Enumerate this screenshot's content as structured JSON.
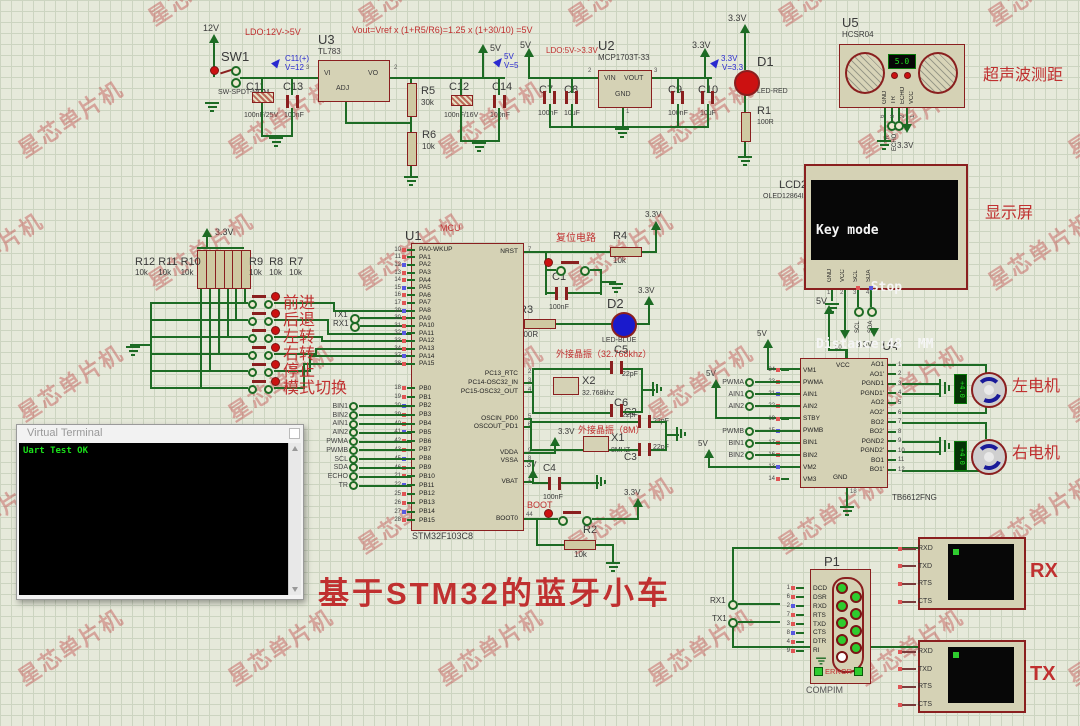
{
  "watermark": {
    "text": "星芯单片机"
  },
  "title": {
    "text": "基于STM32的蓝牙小车"
  },
  "rails": {
    "v12": "12V",
    "v5": "5V",
    "v33": "3.3V"
  },
  "notes": {
    "ldo1": "LDO:12V->5V",
    "formula": "Vout=Vref x (1+R5/R6)=1.25 x (1+30/10) =5V",
    "ldo2": "LDO:5V->3.3V",
    "reset": "复位电路",
    "xtal_lse": "外接晶振（32.768khz）",
    "xtal_hse": "外接晶振（8M）",
    "boot": "BOOT",
    "mcu_tag": "MCU",
    "ultrasonic": "超声波测距",
    "display": "显示屏",
    "motor_left": "左电机",
    "motor_right": "右电机"
  },
  "probes": {
    "c11": {
      "label": "C11(+)",
      "v": "V=12"
    },
    "v5": {
      "label": "5V",
      "v": "V=5"
    },
    "v33": {
      "label": "3.3V",
      "v": "V=3.3"
    }
  },
  "sw1": {
    "ref": "SW1",
    "val": "SW-SPDT-MOM"
  },
  "u3": {
    "ref": "U3",
    "val": "TL783",
    "vi": "VI",
    "vo": "VO",
    "adj": "ADJ",
    "n_in": "3",
    "n_out": "2"
  },
  "u2": {
    "ref": "U2",
    "val": "MCP1703T-33",
    "vin": "VIN",
    "vout": "VOUT",
    "gnd": "GND",
    "n_in": "2",
    "n_out": "3",
    "n_gnd": "1"
  },
  "caps": {
    "c11": {
      "ref": "C11",
      "val": "100nF/25V"
    },
    "c13": {
      "ref": "C13",
      "val": "100nF"
    },
    "c12": {
      "ref": "C12",
      "val": "100nF/16V"
    },
    "c14": {
      "ref": "C14",
      "val": "100nF"
    },
    "c7": {
      "ref": "C7",
      "val": "100nF"
    },
    "c8": {
      "ref": "C8",
      "val": "10uF"
    },
    "c9": {
      "ref": "C9",
      "val": "100nF"
    },
    "c10": {
      "ref": "C10",
      "val": "10uF"
    },
    "c1": {
      "ref": "C1",
      "val": "100nF"
    },
    "c5": {
      "ref": "C5",
      "val": "22pF"
    },
    "c6": {
      "ref": "C6",
      "val": "22pF"
    },
    "c2": {
      "ref": "C2",
      "val": "22pF"
    },
    "c3": {
      "ref": "C3",
      "val": "22pF"
    },
    "c4": {
      "ref": "C4",
      "val": "100nF"
    }
  },
  "resistors": {
    "r5": {
      "ref": "R5",
      "val": "30k"
    },
    "r6": {
      "ref": "R6",
      "val": "10k"
    },
    "r1": {
      "ref": "R1",
      "val": "100R"
    },
    "r4": {
      "ref": "R4",
      "val": "10k"
    },
    "r3": {
      "ref": "R3",
      "val": "100R"
    },
    "r2": {
      "ref": "R2",
      "val": "10k"
    }
  },
  "leds": {
    "d1": {
      "ref": "D1",
      "val": "LED-RED"
    },
    "d2": {
      "ref": "D2",
      "val": "LED-BLUE"
    }
  },
  "xtals": {
    "x2": {
      "ref": "X2",
      "val": "32.768khz"
    },
    "x1": {
      "ref": "X1",
      "val": "8MHZ"
    }
  },
  "ultrasonic": {
    "ref": "U5",
    "val": "HCSR04",
    "display": "5.0",
    "pins": [
      "GND",
      "TR",
      "ECHO",
      "VCC"
    ],
    "pin_numbers": [
      "6",
      "3",
      "2",
      "1"
    ],
    "terms": [
      "TR",
      "ECHO"
    ]
  },
  "lcd": {
    "ref": "LCD2",
    "val": "OLED12864I2C",
    "lines": [
      "Key mode",
      "       Stop",
      "Distance:48  MM"
    ],
    "pins": [
      {
        "n": "1",
        "name": "GND"
      },
      {
        "n": "2",
        "name": "VCC"
      },
      {
        "n": "3",
        "name": "SCL"
      },
      {
        "n": "4",
        "name": "SDA"
      }
    ],
    "terms": [
      "SCL",
      "SDA"
    ]
  },
  "mcu": {
    "ref": "U1",
    "val": "STM32F103C8",
    "pa_pins": [
      {
        "n": "10",
        "name": "PA0-WKUP"
      },
      {
        "n": "11",
        "name": "PA1"
      },
      {
        "n": "12",
        "name": "PA2"
      },
      {
        "n": "13",
        "name": "PA3"
      },
      {
        "n": "14",
        "name": "PA4"
      },
      {
        "n": "15",
        "name": "PA5"
      },
      {
        "n": "16",
        "name": "PA6"
      },
      {
        "n": "17",
        "name": "PA7"
      },
      {
        "n": "29",
        "name": "PA8"
      },
      {
        "n": "30",
        "name": "PA9"
      },
      {
        "n": "31",
        "name": "PA10"
      },
      {
        "n": "32",
        "name": "PA11"
      },
      {
        "n": "33",
        "name": "PA12"
      },
      {
        "n": "34",
        "name": "PA13"
      },
      {
        "n": "37",
        "name": "PA14"
      },
      {
        "n": "38",
        "name": "PA15"
      }
    ],
    "pb_pins": [
      {
        "n": "18",
        "name": "PB0"
      },
      {
        "n": "19",
        "name": "PB1"
      },
      {
        "n": "20",
        "name": "PB2"
      },
      {
        "n": "39",
        "name": "PB3"
      },
      {
        "n": "40",
        "name": "PB4"
      },
      {
        "n": "41",
        "name": "PB5"
      },
      {
        "n": "42",
        "name": "PB6"
      },
      {
        "n": "43",
        "name": "PB7"
      },
      {
        "n": "45",
        "name": "PB8"
      },
      {
        "n": "46",
        "name": "PB9"
      },
      {
        "n": "21",
        "name": "PB10"
      },
      {
        "n": "22",
        "name": "PB11"
      },
      {
        "n": "25",
        "name": "PB12"
      },
      {
        "n": "26",
        "name": "PB13"
      },
      {
        "n": "27",
        "name": "PB14"
      },
      {
        "n": "28",
        "name": "PB15"
      }
    ],
    "right_pins": [
      {
        "n": "7",
        "name": "NRST"
      },
      {
        "n": "2",
        "name": "PC13_RTC"
      },
      {
        "n": "3",
        "name": "PC14-OSC32_IN"
      },
      {
        "n": "4",
        "name": "PC15-OSC32_OUT"
      },
      {
        "n": "5",
        "name": "OSCIN_PD0"
      },
      {
        "n": "6",
        "name": "OSCOUT_PD1"
      },
      {
        "n": "9",
        "name": "VDDA"
      },
      {
        "n": "8",
        "name": "VSSA"
      },
      {
        "n": "1",
        "name": "VBAT"
      },
      {
        "n": "44",
        "name": "BOOT0"
      }
    ]
  },
  "keys": {
    "res_left": [
      {
        "ref": "R12",
        "val": "10k"
      },
      {
        "ref": "R11",
        "val": "10k"
      },
      {
        "ref": "R10",
        "val": "10k"
      }
    ],
    "res_right": [
      {
        "ref": "R9",
        "val": "10k"
      },
      {
        "ref": "R8",
        "val": "10k"
      },
      {
        "ref": "R7",
        "val": "10k"
      }
    ],
    "buttons": [
      "前进",
      "后退",
      "左转",
      "右转",
      "停止",
      "模式切换"
    ]
  },
  "uart": {
    "tx1": "TX1",
    "rx1": "RX1"
  },
  "mcu_terms": [
    "BIN1",
    "BIN2",
    "AIN1",
    "AIN2",
    "PWMA",
    "PWMB",
    "SCL",
    "SDA",
    "ECHO",
    "TR"
  ],
  "terminal_window": {
    "title": "Virtual Terminal",
    "text": "Uart Test OK"
  },
  "driver": {
    "ref": "U4",
    "val": "TB6612FNG",
    "vcc": {
      "n": "20",
      "name": "VCC"
    },
    "gnd": {
      "n": "18",
      "name": "GND"
    },
    "left_pins": [
      {
        "n": "24",
        "name": "VM1"
      },
      {
        "n": "23",
        "name": "PWMA"
      },
      {
        "n": "21",
        "name": "AIN1"
      },
      {
        "n": "22",
        "name": "AIN2"
      },
      {
        "n": "19",
        "name": "STBY"
      },
      {
        "n": "15",
        "name": "PWMB"
      },
      {
        "n": "17",
        "name": "BIN1"
      },
      {
        "n": "16",
        "name": "BIN2"
      },
      {
        "n": "13",
        "name": "VM2"
      },
      {
        "n": "14",
        "name": "VM3"
      }
    ],
    "right_pins": [
      {
        "n": "1",
        "name": "AO1"
      },
      {
        "n": "2",
        "name": "AO1'"
      },
      {
        "n": "3",
        "name": "PGND1"
      },
      {
        "n": "4",
        "name": "PGND1'"
      },
      {
        "n": "5",
        "name": "AO2"
      },
      {
        "n": "6",
        "name": "AO2'"
      },
      {
        "n": "7",
        "name": "BO2"
      },
      {
        "n": "8",
        "name": "BO2'"
      },
      {
        "n": "9",
        "name": "PGND2"
      },
      {
        "n": "10",
        "name": "PGND2'"
      },
      {
        "n": "11",
        "name": "BO1"
      },
      {
        "n": "12",
        "name": "BO1'"
      }
    ],
    "terms_a": [
      "PWMA",
      "AIN1",
      "AIN2"
    ],
    "terms_b": [
      "PWMB",
      "BIN1",
      "BIN2"
    ]
  },
  "motors": {
    "display": "+4.0"
  },
  "compim": {
    "ref": "P1",
    "val": "COMPIM",
    "error": "ERROR",
    "pins": [
      {
        "n": "1",
        "name": "DCD"
      },
      {
        "n": "6",
        "name": "DSR"
      },
      {
        "n": "2",
        "name": "RXD"
      },
      {
        "n": "7",
        "name": "RTS"
      },
      {
        "n": "3",
        "name": "TXD"
      },
      {
        "n": "8",
        "name": "CTS"
      },
      {
        "n": "4",
        "name": "DTR"
      },
      {
        "n": "9",
        "name": "RI"
      }
    ]
  },
  "serial_rx": {
    "label": "RX",
    "pins": [
      "RXD",
      "TXD",
      "RTS",
      "CTS"
    ]
  },
  "serial_tx": {
    "label": "TX",
    "pins": [
      "RXD",
      "TXD",
      "RTS",
      "CTS"
    ]
  },
  "colors": {
    "wire": "#1d6b24",
    "component_border": "#8a1f1f",
    "component_fill": "#d5d2b5",
    "annotation_red": "#c03030",
    "probe_blue": "#2a2ad0",
    "terminal_green": "#1ae01a"
  }
}
